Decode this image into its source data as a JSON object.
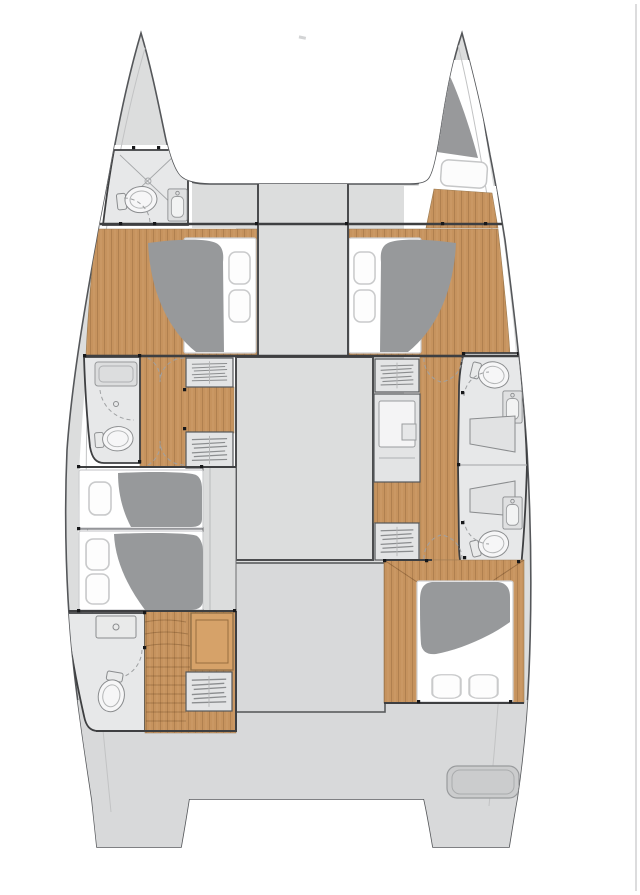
{
  "plan": {
    "name": "catamaran-interior-deck-plan",
    "colors": {
      "background": "#ffffff",
      "hull": "#dcdddd",
      "aft_deck": "#d8d9da",
      "wood": "#c6935e",
      "cabinet_wood": "#d6a269",
      "duvet": "#97999b",
      "bow_locker": "#98999b",
      "bathroom_floor": "#e7e8e9",
      "furniture": "#e3e4e5",
      "fixture_fill": "#f4f5f5",
      "fixture_line": "#8a8c8e",
      "wall": "#3e3f41",
      "hull_outline": "#55575a",
      "hatch": "#cbcccd",
      "page_edge_line": "#d0d1d2",
      "mattress": "#ffffff"
    },
    "regions": {
      "port_bow_head": "port bow bathroom with shower, toilet and sink",
      "starboard_bow_locker": "starboard bow locker with deck hatch",
      "foredeck": "foredeck between the bows",
      "port_forward_cabin": "port forward cabin with double berth",
      "starboard_forward_cabin": "starboard forward cabin with double berth",
      "saloon": "central saloon block",
      "cockpit": "central cockpit block",
      "port_mid_head": "port mid bathroom with shower and toilet",
      "starboard_heads": "starboard twin bathrooms with toilets, sinks and shower benches",
      "port_aft_cabin": "port aft cabin with two berths",
      "port_aft_head": "port aft bathroom with sink, shower and toilet",
      "port_aft_stairs": "port aft companionway steps and lockers",
      "starboard_aft_cabin": "starboard aft cabin with double berth",
      "aft_deck": "aft deck and twin transoms"
    },
    "fixture_counts": {
      "berths": 5,
      "toilets": 5,
      "sinks": 4,
      "showers": 3,
      "stair_lockers": 5,
      "deck_hatches": 2
    }
  }
}
